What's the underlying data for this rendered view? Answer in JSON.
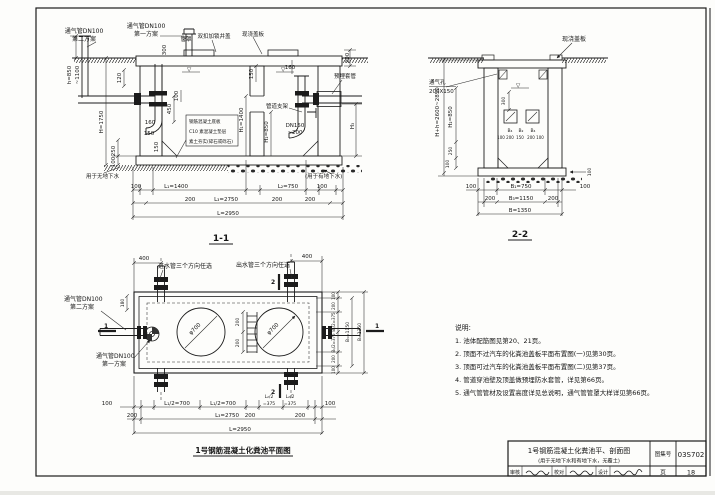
{
  "s11": {
    "title": "1-1",
    "vent2_line1": "通气管DN100",
    "vent2_line2": "第二方案",
    "vent1_line1": "通气管DN100",
    "vent1_line2": "第一方案",
    "pipe_cap": "管罩",
    "cover": "双扣加锁井盖",
    "cast_slab": "现浇盖板",
    "sleeve": "预埋套管",
    "support": "管道支架",
    "slab_note1": "钢筋混凝土底板",
    "slab_note2": "C10 素混凝土垫层",
    "slab_note3": "素土夯实(碎石或砾石)",
    "no_gw": "用于无地下水",
    "gw": "(用于有地下水)",
    "dn1": "DN150",
    "dn2": "~200",
    "d_h1": "h=850",
    "d_h2": "~1100",
    "d300": "300",
    "d120": "120",
    "d200top": "200",
    "dH": "H=1750",
    "d250": "250",
    "d100l": "100",
    "d160a": "160",
    "d150a": "150",
    "d150b": "150",
    "d450": "450",
    "d100in": "100",
    "d150part": "150",
    "d160b": "160",
    "dH1": "H₁=1400",
    "dH2": "H₂=850",
    "dH3": "H₃",
    "b100a": "100",
    "bL1": "L₁=1400",
    "bL2": "L₂=750",
    "b100b": "100",
    "b200a": "200",
    "bL3": "L₃=2750",
    "b200b": "200",
    "b200c": "200",
    "bL": "L=2950"
  },
  "s22": {
    "title": "2-2",
    "cast_slab": "现浇盖板",
    "vent1": "通气孔",
    "vent2": "200X150",
    "dHh": "H+h=2600~2850",
    "dH2": "H₂=850",
    "d250": "250",
    "d100l": "100",
    "d300": "300",
    "b4a": "B₄",
    "b2": "B₂",
    "b4b": "B₄",
    "seg": [
      "100",
      "200",
      "150",
      "200",
      "100"
    ],
    "d100slab": "100",
    "b100a": "100",
    "bB1": "B₁=750",
    "b100b": "100",
    "b200a": "200",
    "bB3": "B₃=1150",
    "b200b": "200",
    "bB": "B=1350"
  },
  "plan": {
    "title": "1号钢筋混凝土化粪池平面图",
    "inlet": "进水管三个方向任选",
    "outlet": "出水管三个方向任选",
    "vent2_line1": "通气管DN100",
    "vent2_line2": "第二方案",
    "vent1_line1": "通气管DN100",
    "vent1_line2": "第一方案",
    "m1": "1",
    "m2": "2",
    "d400a": "400",
    "d400b": "400",
    "d180": "180",
    "phi": "φ700",
    "d200a": "200",
    "d200b": "200",
    "r100a": "100",
    "r200a": "200",
    "rB12a": "B₁/2=375",
    "rB12b": "B₁/2=375",
    "r200b": "200",
    "r100b": "100",
    "rB3": "B₃=1150",
    "rB": "B=1350",
    "b100a": "100",
    "bL12a": "L₁/2=700",
    "bL12b": "L₁/2=700",
    "bL22a1": "L₂/2",
    "bL22a2": "=375",
    "bL22b1": "L₂/2",
    "bL22b2": "=375",
    "b100b": "100",
    "b200a": "200",
    "bL3": "L₃=2750",
    "b200b": "200",
    "b200c": "200",
    "bL": "L=2950"
  },
  "notes": {
    "heading": "说明:",
    "items": [
      "1. 池体配筋图见第20、21页。",
      "2. 顶面不过汽车的化粪池盖板平面布置图(一)见第30页。",
      "3. 顶面可过汽车的化粪池盖板平面布置图(二)见第37页。",
      "4. 管道穿池壁及顶盖做预埋防水套管，详见第66页。",
      "5. 通气管管材及设置高度详见总说明，通气管管罩大样详见第66页。"
    ]
  },
  "tb": {
    "title1": "1号钢筋混凝土化粪池平、剖面图",
    "title2": "(用于无地下水和有地下水，无覆土)",
    "atlas_label": "图集号",
    "atlas_no": "03S702",
    "page_label": "页",
    "page_no": "18",
    "sig1": "审核",
    "sig2": "校对",
    "sig3": "设计"
  }
}
